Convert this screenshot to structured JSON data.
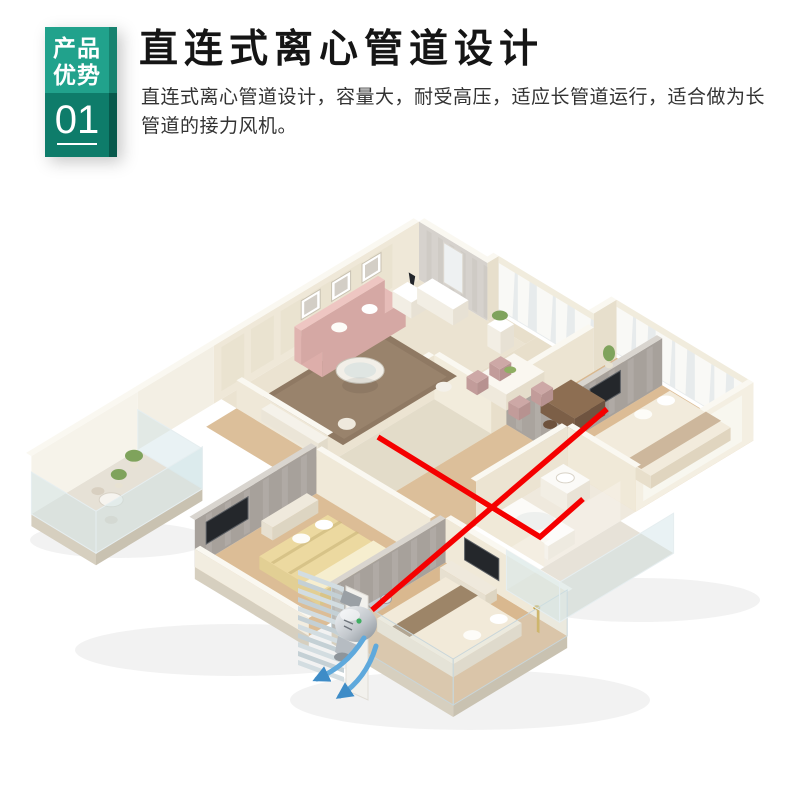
{
  "badge": {
    "tagline_line1": "产品",
    "tagline_line2": "优势",
    "number": "01"
  },
  "header": {
    "title": "直连式离心管道设计",
    "description_line1": "直连式离心管道设计，容量大，耐受高压，适应长管道运行，适合做为长",
    "description_line2": "管道的接力风机。"
  },
  "colors": {
    "badge_teal_top": "#21A28C",
    "badge_teal_bottom": "#0E7C6A",
    "duct_line_red": "#F50000",
    "airflow_arrow_blue": "#5FA9DC",
    "fan_body_silver": "#C3C8CD"
  }
}
